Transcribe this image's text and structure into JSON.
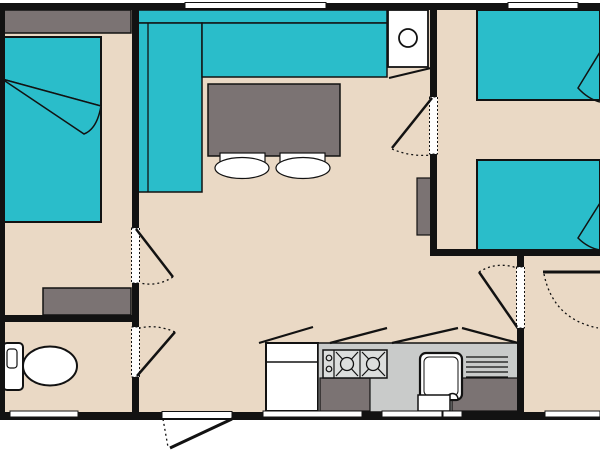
{
  "palette": {
    "wall": "#121212",
    "floor": "#ead9c5",
    "teal": "#2abdca",
    "gray": "#7b7373",
    "counter": "#c9cbca",
    "stove": "#dcdedd",
    "white": "#ffffff"
  },
  "canvas": {
    "width": 600,
    "height": 450
  },
  "floorplan": {
    "description": "Mobile home floor plan: master bedroom left, living-dining centre, twin bedroom top right, bedroom bottom right, bathroom bottom left, kitchen bottom centre",
    "shapes": [
      {
        "name": "floor",
        "type": "rect",
        "x": 0,
        "y": 3,
        "w": 600,
        "h": 417,
        "fill": "floor"
      },
      {
        "name": "headboard-shelf",
        "type": "rect",
        "x": 0,
        "y": 10,
        "w": 131,
        "h": 23,
        "fill": "gray",
        "sw": 1.5
      },
      {
        "name": "double-bed",
        "type": "rect",
        "x": 0,
        "y": 37,
        "w": 101,
        "h": 185,
        "fill": "teal",
        "sw": 2
      },
      {
        "name": "double-bed-sheet-line",
        "type": "line",
        "x1": 2,
        "y1": 79,
        "x2": 101,
        "y2": 106,
        "sw": 1.5
      },
      {
        "name": "double-bed-fold",
        "type": "path",
        "d": "M2,79 L101,106 Q97,129 84,134 Z",
        "fill": "teal",
        "sw": 1.5
      },
      {
        "name": "bedroom-shelf",
        "type": "rect",
        "x": 43,
        "y": 288,
        "w": 88,
        "h": 27,
        "fill": "gray",
        "sw": 1.5
      },
      {
        "name": "sofa-back",
        "type": "rect",
        "x": 137,
        "y": 10,
        "w": 250,
        "h": 13,
        "fill": "teal",
        "sw": 1.5
      },
      {
        "name": "sofa-bench-left",
        "type": "rect",
        "x": 137,
        "y": 23,
        "w": 65,
        "h": 169,
        "fill": "teal",
        "sw": 1.5
      },
      {
        "name": "sofa-armrest-line",
        "type": "line",
        "x1": 148,
        "y1": 23,
        "x2": 148,
        "y2": 192,
        "sw": 1.3
      },
      {
        "name": "sofa-bench-top",
        "type": "rect",
        "x": 202,
        "y": 23,
        "w": 185,
        "h": 54,
        "fill": "teal",
        "sw": 1.5
      },
      {
        "name": "dining-table",
        "type": "rect",
        "x": 208,
        "y": 84,
        "w": 132,
        "h": 72,
        "fill": "gray",
        "sw": 1.5
      },
      {
        "name": "stool-1-back",
        "type": "rect",
        "x": 220,
        "y": 153,
        "w": 45,
        "h": 12,
        "fill": "white",
        "sw": 1.2
      },
      {
        "name": "stool-1",
        "type": "ellipse",
        "cx": 242,
        "cy": 168,
        "rx": 27,
        "ry": 10.5,
        "fill": "white",
        "sw": 1.2
      },
      {
        "name": "stool-2-back",
        "type": "rect",
        "x": 280,
        "y": 153,
        "w": 45,
        "h": 12,
        "fill": "white",
        "sw": 1.2
      },
      {
        "name": "stool-2",
        "type": "ellipse",
        "cx": 303,
        "cy": 168,
        "rx": 27,
        "ry": 10.5,
        "fill": "white",
        "sw": 1.2
      },
      {
        "name": "boiler-closet",
        "type": "rect",
        "x": 388,
        "y": 10,
        "w": 40,
        "h": 57,
        "fill": "white",
        "sw": 1.8
      },
      {
        "name": "boiler",
        "type": "circle",
        "cx": 408,
        "cy": 38,
        "r": 9,
        "fill": "white",
        "sw": 1.8
      },
      {
        "name": "closet-door-line",
        "type": "line",
        "x1": 389,
        "y1": 78,
        "x2": 431,
        "y2": 68,
        "sw": 2
      },
      {
        "name": "wardrobe",
        "type": "rect",
        "x": 417,
        "y": 178,
        "w": 15,
        "h": 57,
        "fill": "gray",
        "sw": 1.2
      },
      {
        "name": "single-bed-1",
        "type": "rect",
        "x": 477,
        "y": 10,
        "w": 123,
        "h": 90,
        "fill": "teal",
        "sw": 2
      },
      {
        "name": "single-bed-1-fold",
        "type": "path",
        "d": "M600,52 L578,88 Q588,99 600,102",
        "sw": 1.5
      },
      {
        "name": "single-bed-2",
        "type": "rect",
        "x": 477,
        "y": 160,
        "w": 123,
        "h": 90,
        "fill": "teal",
        "sw": 2
      },
      {
        "name": "single-bed-2-fold",
        "type": "path",
        "d": "M600,203 L578,238 Q588,248 600,250",
        "sw": 1.5
      },
      {
        "name": "toilet-tank",
        "type": "rect",
        "x": 3,
        "y": 343,
        "w": 20,
        "h": 47,
        "rx": 4,
        "fill": "white",
        "sw": 2
      },
      {
        "name": "toilet-tank-button",
        "type": "rect",
        "x": 7,
        "y": 349,
        "w": 10,
        "h": 19,
        "rx": 3,
        "sw": 1.2
      },
      {
        "name": "toilet-bowl",
        "type": "ellipse",
        "cx": 50,
        "cy": 366,
        "rx": 27,
        "ry": 19.5,
        "fill": "white",
        "sw": 2
      },
      {
        "name": "fridge",
        "type": "rect",
        "x": 266,
        "y": 343,
        "w": 52,
        "h": 68,
        "fill": "white",
        "sw": 2
      },
      {
        "name": "fridge-divider-line",
        "type": "line",
        "x1": 266,
        "y1": 362,
        "x2": 318,
        "y2": 362,
        "sw": 1.5
      },
      {
        "name": "kitchen-counter",
        "type": "rect",
        "x": 318,
        "y": 343,
        "w": 200,
        "h": 69,
        "fill": "counter",
        "sw": 1.5
      },
      {
        "name": "cabinet-left",
        "type": "rect",
        "x": 320,
        "y": 378,
        "w": 50,
        "h": 33,
        "fill": "gray",
        "sw": 1.2
      },
      {
        "name": "cabinet-right",
        "type": "rect",
        "x": 452,
        "y": 378,
        "w": 66,
        "h": 33,
        "fill": "gray",
        "sw": 1.2
      },
      {
        "name": "stove",
        "type": "rect",
        "x": 323,
        "y": 350,
        "w": 64,
        "h": 28,
        "fill": "stove",
        "sw": 1.5
      },
      {
        "name": "stove-divider-1",
        "type": "line",
        "x1": 334,
        "y1": 350,
        "x2": 334,
        "y2": 378,
        "sw": 1.2
      },
      {
        "name": "stove-divider-2",
        "type": "line",
        "x1": 360,
        "y1": 350,
        "x2": 360,
        "y2": 378,
        "sw": 1.2
      },
      {
        "name": "stove-knob-1",
        "type": "circle",
        "cx": 329,
        "cy": 358,
        "r": 2.8,
        "sw": 1.2
      },
      {
        "name": "stove-knob-2",
        "type": "circle",
        "cx": 329,
        "cy": 369,
        "r": 2.8,
        "sw": 1.2
      },
      {
        "name": "burner-1-cross-a",
        "type": "line",
        "x1": 336,
        "y1": 352,
        "x2": 358,
        "y2": 376,
        "sw": 1.2
      },
      {
        "name": "burner-1-cross-b",
        "type": "line",
        "x1": 336,
        "y1": 376,
        "x2": 358,
        "y2": 352,
        "sw": 1.2
      },
      {
        "name": "burner-2-cross-a",
        "type": "line",
        "x1": 362,
        "y1": 352,
        "x2": 385,
        "y2": 376,
        "sw": 1.2
      },
      {
        "name": "burner-2-cross-b",
        "type": "line",
        "x1": 362,
        "y1": 376,
        "x2": 385,
        "y2": 352,
        "sw": 1.2
      },
      {
        "name": "burner-1",
        "type": "circle",
        "cx": 347,
        "cy": 364,
        "r": 6.5,
        "fill": "stove",
        "sw": 1.3
      },
      {
        "name": "burner-2",
        "type": "circle",
        "cx": 373,
        "cy": 364,
        "r": 6.5,
        "fill": "stove",
        "sw": 1.3
      },
      {
        "name": "sink",
        "type": "rect",
        "x": 420,
        "y": 353,
        "w": 42,
        "h": 47,
        "rx": 6,
        "fill": "white",
        "sw": 2.2
      },
      {
        "name": "sink-inner",
        "type": "rect",
        "x": 424,
        "y": 357,
        "w": 34,
        "h": 39,
        "rx": 5,
        "sw": 1
      },
      {
        "name": "faucet",
        "type": "path",
        "d": "M447,399 A5.5,5.5 0 0 1 458,399",
        "fill": "white",
        "sw": 1.5
      },
      {
        "name": "dishwasher",
        "type": "rect",
        "x": 418,
        "y": 395,
        "w": 32,
        "h": 16,
        "fill": "white",
        "sw": 1.5
      },
      {
        "name": "drainboard-line-1",
        "type": "line",
        "x1": 466,
        "y1": 357,
        "x2": 508,
        "y2": 357,
        "sw": 1.2
      },
      {
        "name": "drainboard-line-2",
        "type": "line",
        "x1": 466,
        "y1": 362,
        "x2": 508,
        "y2": 362,
        "sw": 1.2
      },
      {
        "name": "drainboard-line-3",
        "type": "line",
        "x1": 466,
        "y1": 367,
        "x2": 508,
        "y2": 367,
        "sw": 1.2
      },
      {
        "name": "drainboard-line-4",
        "type": "line",
        "x1": 466,
        "y1": 372,
        "x2": 508,
        "y2": 372,
        "sw": 1.2
      },
      {
        "name": "drainboard-line-5",
        "type": "line",
        "x1": 466,
        "y1": 377,
        "x2": 508,
        "y2": 377,
        "sw": 1.2
      },
      {
        "name": "wall-top",
        "type": "rect",
        "x": 0,
        "y": 3,
        "w": 600,
        "h": 7,
        "fill": "wall"
      },
      {
        "name": "wall-bottom",
        "type": "rect",
        "x": 0,
        "y": 412,
        "w": 600,
        "h": 8,
        "fill": "wall"
      },
      {
        "name": "wall-left",
        "type": "rect",
        "x": 0,
        "y": 3,
        "w": 5,
        "h": 417,
        "fill": "wall"
      },
      {
        "name": "wall-bedroom1",
        "type": "rect",
        "x": 132,
        "y": 10,
        "w": 7,
        "h": 402,
        "fill": "wall"
      },
      {
        "name": "wall-bedroom2-left",
        "type": "rect",
        "x": 430,
        "y": 10,
        "w": 7,
        "h": 246,
        "fill": "wall"
      },
      {
        "name": "wall-bedroom2-bottom",
        "type": "rect",
        "x": 430,
        "y": 249,
        "w": 170,
        "h": 7,
        "fill": "wall"
      },
      {
        "name": "wall-bedroom3-left",
        "type": "rect",
        "x": 517,
        "y": 256,
        "w": 7,
        "h": 156,
        "fill": "wall"
      },
      {
        "name": "wall-bathroom-top",
        "type": "rect",
        "x": 0,
        "y": 315,
        "w": 132,
        "h": 7,
        "fill": "wall"
      },
      {
        "name": "overhead-cabinet-line-1",
        "type": "line",
        "x1": 259,
        "y1": 343,
        "x2": 313,
        "y2": 327,
        "sw": 2.2
      },
      {
        "name": "overhead-cabinet-line-2",
        "type": "line",
        "x1": 330,
        "y1": 343,
        "x2": 387,
        "y2": 328,
        "sw": 2.2
      },
      {
        "name": "overhead-cabinet-line-3",
        "type": "line",
        "x1": 392,
        "y1": 343,
        "x2": 458,
        "y2": 328,
        "sw": 2.2
      },
      {
        "name": "overhead-cabinet-line-4",
        "type": "line",
        "x1": 462,
        "y1": 328,
        "x2": 518,
        "y2": 343,
        "sw": 2.2
      },
      {
        "name": "window-top-1",
        "type": "rect",
        "x": 185,
        "y": 2.5,
        "w": 141,
        "h": 6,
        "fill": "white",
        "sw": 1
      },
      {
        "name": "window-top-2",
        "type": "rect",
        "x": 508,
        "y": 2.5,
        "w": 70,
        "h": 6,
        "fill": "white",
        "sw": 1
      },
      {
        "name": "window-bottom-1",
        "type": "rect",
        "x": 10,
        "y": 411,
        "w": 68,
        "h": 6,
        "fill": "white",
        "sw": 1
      },
      {
        "name": "entrance-opening",
        "type": "rect",
        "x": 162,
        "y": 411.5,
        "w": 70,
        "h": 7,
        "fill": "white",
        "sw": 1
      },
      {
        "name": "window-bottom-2",
        "type": "rect",
        "x": 263,
        "y": 411,
        "w": 99,
        "h": 6,
        "fill": "white",
        "sw": 1
      },
      {
        "name": "window-bottom-3",
        "type": "rect",
        "x": 382,
        "y": 411,
        "w": 60,
        "h": 6,
        "fill": "white",
        "sw": 1
      },
      {
        "name": "window-bottom-4",
        "type": "rect",
        "x": 443,
        "y": 411,
        "w": 19,
        "h": 6,
        "fill": "white",
        "sw": 1
      },
      {
        "name": "window-bottom-5",
        "type": "rect",
        "x": 545,
        "y": 411,
        "w": 55,
        "h": 6,
        "fill": "white",
        "sw": 1
      },
      {
        "name": "doorway-bedroom1",
        "type": "rect",
        "x": 131.5,
        "y": 228,
        "w": 8,
        "h": 55,
        "fill": "white",
        "sw": 1,
        "dash": "2,2"
      },
      {
        "name": "doorway-bathroom",
        "type": "rect",
        "x": 131.5,
        "y": 327,
        "w": 8,
        "h": 50,
        "fill": "white",
        "sw": 1,
        "dash": "2,2"
      },
      {
        "name": "doorway-bedroom2",
        "type": "rect",
        "x": 429.5,
        "y": 97,
        "w": 8,
        "h": 57,
        "fill": "white",
        "sw": 1,
        "dash": "2,2"
      },
      {
        "name": "doorway-bedroom3",
        "type": "rect",
        "x": 516.5,
        "y": 267,
        "w": 8,
        "h": 61,
        "fill": "white",
        "sw": 1,
        "dash": "2,2"
      },
      {
        "name": "door-bedroom1-leaf",
        "type": "line",
        "x1": 136,
        "y1": 229,
        "x2": 173,
        "y2": 277,
        "sw": 2.5
      },
      {
        "name": "door-bedroom1-swing",
        "type": "path",
        "d": "M173,277 Q157,287 140,283",
        "sw": 1.3,
        "dash": "2,3"
      },
      {
        "name": "door-bathroom-leaf",
        "type": "line",
        "x1": 137,
        "y1": 376,
        "x2": 175,
        "y2": 332,
        "sw": 2.5
      },
      {
        "name": "door-bathroom-swing",
        "type": "path",
        "d": "M175,332 Q156,324 140,328",
        "sw": 1.3,
        "dash": "2,3"
      },
      {
        "name": "door-bedroom2-leaf",
        "type": "line",
        "x1": 432,
        "y1": 98,
        "x2": 392,
        "y2": 148,
        "sw": 2.5
      },
      {
        "name": "door-bedroom2-swing",
        "type": "path",
        "d": "M392,149 Q411,157 431,155",
        "sw": 1.3,
        "dash": "2,3"
      },
      {
        "name": "door-bedroom3-leaf",
        "type": "line",
        "x1": 517,
        "y1": 327,
        "x2": 479,
        "y2": 272,
        "sw": 2.5
      },
      {
        "name": "door-bedroom3-swing",
        "type": "path",
        "d": "M479,272 Q497,261 517,268",
        "sw": 1.3,
        "dash": "2,3"
      },
      {
        "name": "door-right-leaf",
        "type": "line",
        "x1": 543,
        "y1": 272,
        "x2": 600,
        "y2": 272,
        "sw": 3
      },
      {
        "name": "door-right-swing",
        "type": "path",
        "d": "M544,274 Q553,319 598,328",
        "sw": 1.3,
        "dash": "2,3"
      },
      {
        "name": "door-entrance-leaf",
        "type": "line",
        "x1": 232,
        "y1": 419,
        "x2": 170,
        "y2": 448,
        "sw": 3
      },
      {
        "name": "door-entrance-swing",
        "type": "line",
        "x1": 163,
        "y1": 419,
        "x2": 168,
        "y2": 447,
        "sw": 1.3,
        "dash": "2,3"
      }
    ]
  }
}
